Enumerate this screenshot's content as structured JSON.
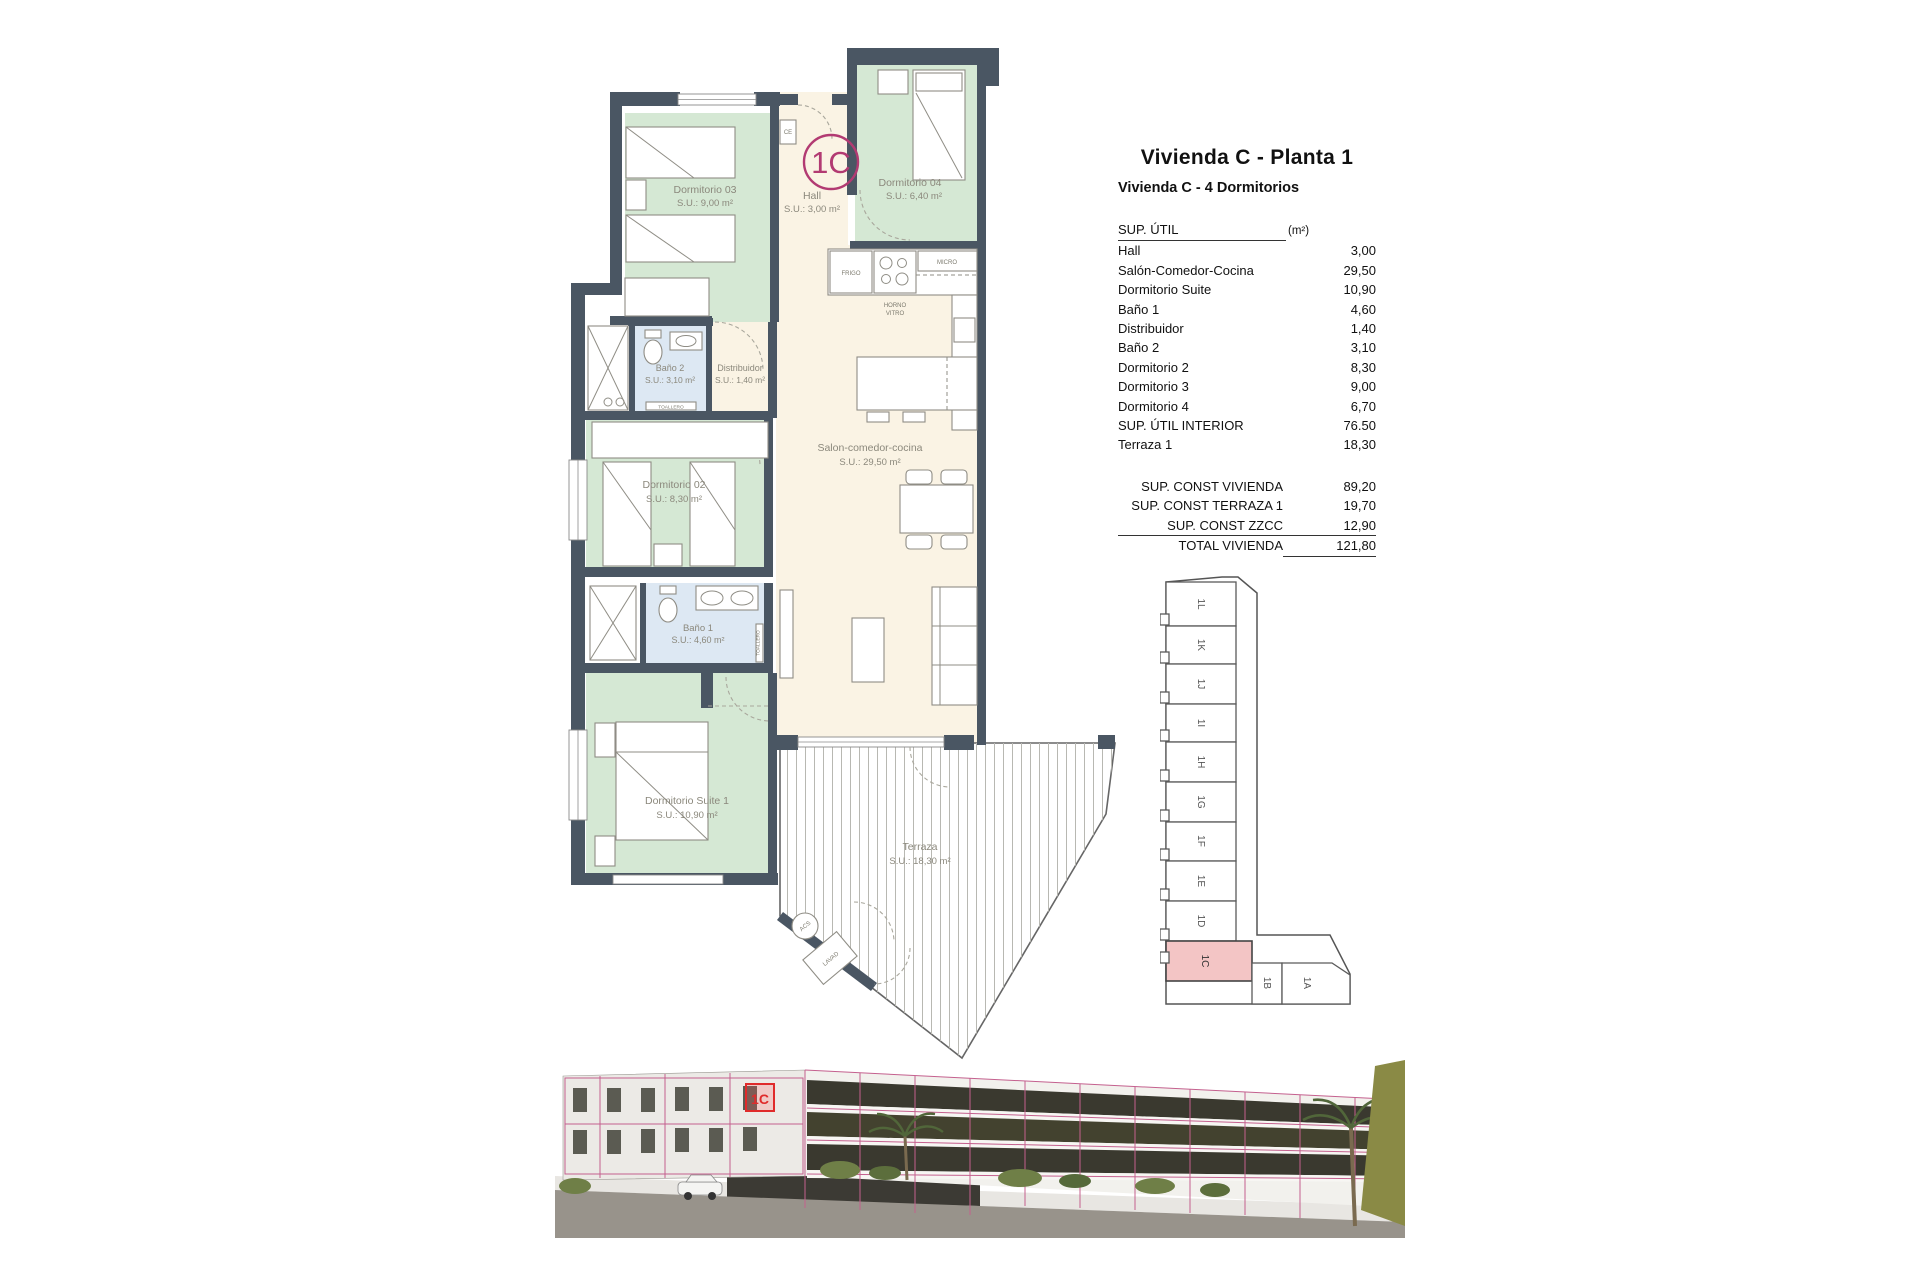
{
  "header": {
    "title": "Vivienda C - Planta 1",
    "subtitle": "Vivienda C - 4 Dormitorios"
  },
  "table": {
    "header": {
      "label": "SUP. ÚTIL",
      "unit": "(m²)"
    },
    "rows": [
      {
        "label": "Hall",
        "value": "3,00"
      },
      {
        "label": "Salón-Comedor-Cocina",
        "value": "29,50"
      },
      {
        "label": "Dormitorio Suite",
        "value": "10,90"
      },
      {
        "label": "Baño 1",
        "value": "4,60"
      },
      {
        "label": "Distribuidor",
        "value": "1,40"
      },
      {
        "label": "Baño 2",
        "value": "3,10"
      },
      {
        "label": "Dormitorio 2",
        "value": "8,30"
      },
      {
        "label": "Dormitorio 3",
        "value": "9,00"
      },
      {
        "label": "Dormitorio 4",
        "value": "6,70"
      },
      {
        "label": "SUP. ÚTIL INTERIOR",
        "value": "76.50"
      },
      {
        "label": "Terraza 1",
        "value": "18,30"
      }
    ],
    "summary": [
      {
        "label": "SUP. CONST VIVIENDA",
        "value": "89,20"
      },
      {
        "label": "SUP. CONST TERRAZA 1",
        "value": "19,70"
      },
      {
        "label": "SUP. CONST ZZCC",
        "value": "12,90"
      },
      {
        "label": "TOTAL VIVIENDA",
        "value": "121,80"
      }
    ]
  },
  "plan": {
    "badge": "1C",
    "rooms": [
      {
        "name": "Dormitorio 03",
        "area": "S.U.: 9,00 m²"
      },
      {
        "name": "Hall",
        "area": "S.U.: 3,00 m²"
      },
      {
        "name": "Dormitorio 04",
        "area": "S.U.: 6,40 m²"
      },
      {
        "name": "Baño 2",
        "area": "S.U.: 3,10 m²"
      },
      {
        "name": "Distribuidor",
        "area": "S.U.: 1,40 m²"
      },
      {
        "name": "Dormitorio 02",
        "area": "S.U.: 8,30 m²"
      },
      {
        "name": "Salon-comedor-cocina",
        "area": "S.U.: 29,50 m²"
      },
      {
        "name": "Baño 1",
        "area": "S.U.: 4,60 m²"
      },
      {
        "name": "Dormitorio Suite 1",
        "area": "S.U.: 10,90 m²"
      },
      {
        "name": "Terraza",
        "area": "S.U.: 18,30 m²"
      }
    ],
    "fixtures": {
      "ce": "CE",
      "frigo": "FRIGO",
      "micro": "MICRO",
      "horno1": "HORNO",
      "horno2": "VITRO",
      "lava": "LAVA",
      "toallero": "TOALLERO",
      "toallero2": "TOALLERO",
      "acs": "ACS",
      "lavad": "LAVAD"
    }
  },
  "key_plan": {
    "highlighted_unit": "1C",
    "units": [
      "1L",
      "1K",
      "1J",
      "1I",
      "1H",
      "1G",
      "1F",
      "1E",
      "1D",
      "1C",
      "1B",
      "1A"
    ]
  },
  "render": {
    "marker": "1C"
  },
  "colors": {
    "wall": "#4a5663",
    "room_green": "#d5e8d4",
    "room_cream": "#faf3e4",
    "room_blue": "#dde8f3",
    "accent_magenta": "#b23a72",
    "key_highlight": "#f3c5c5",
    "render_outline": "#c4608e",
    "marker_red": "#e02b2b"
  }
}
